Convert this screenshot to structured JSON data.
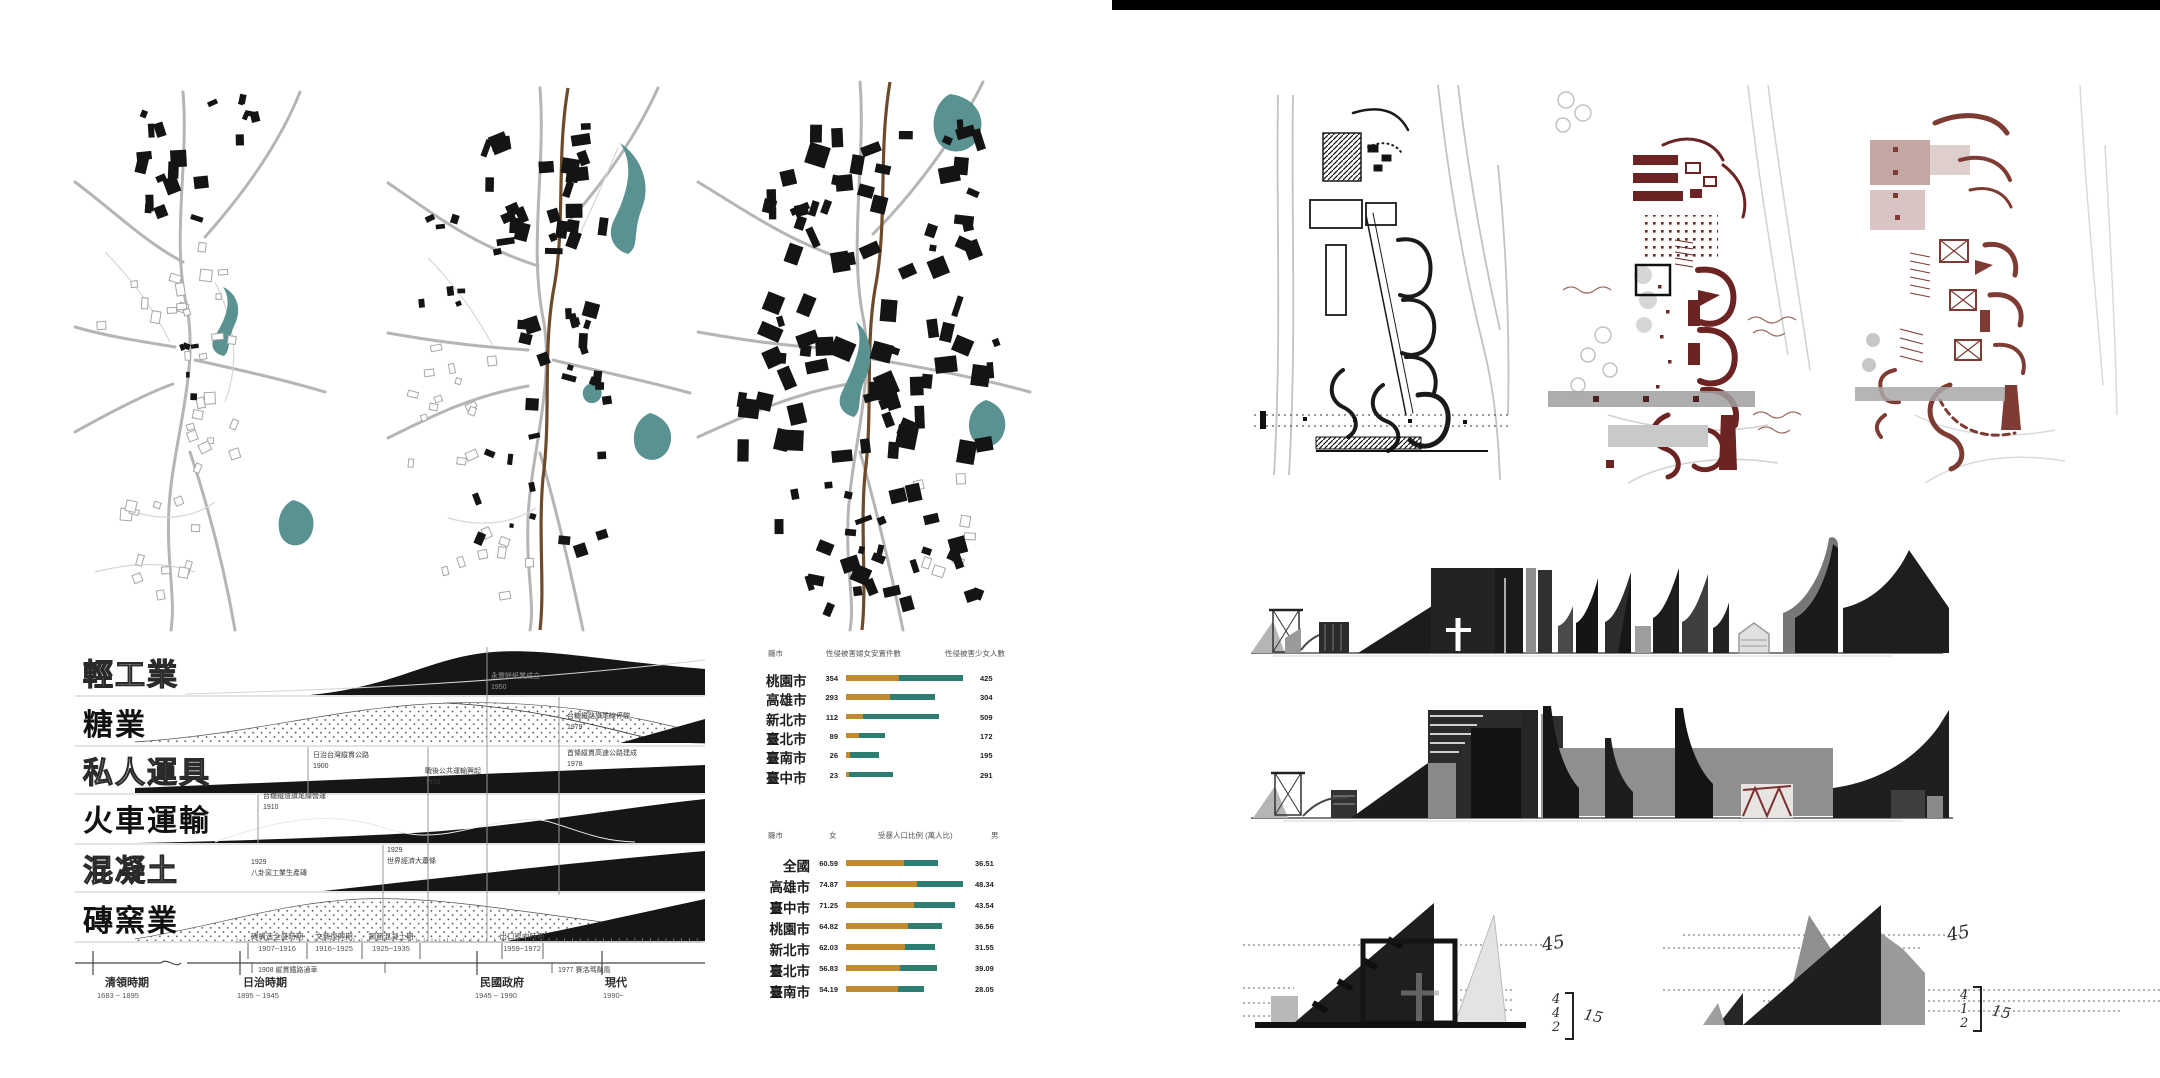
{
  "page": {
    "background": "#ffffff",
    "top_bar_color": "#000000"
  },
  "palette": {
    "ink": "#1a1a1a",
    "water_teal": "#5a9191",
    "road_gray": "#b7b5b3",
    "highway_brown": "#6d4a2a",
    "plan_maroon": "#6b2323",
    "plan_maroon_light": "#7d3b34",
    "bar_gold": "#c28a2e",
    "bar_teal": "#2e7d72"
  },
  "timeline": {
    "rows": [
      {
        "label": "輕工業",
        "style": "outline"
      },
      {
        "label": "糖業",
        "style": "solid"
      },
      {
        "label": "私人運具",
        "style": "outline"
      },
      {
        "label": "火車運輸",
        "style": "solid"
      },
      {
        "label": "混凝土",
        "style": "outline"
      },
      {
        "label": "磚窯業",
        "style": "solid"
      }
    ],
    "annotations": [
      {
        "text": "永豐餘紙業成立",
        "year": "1950"
      },
      {
        "text": "台糖鐵路旗尾線停駛",
        "year": "1979"
      },
      {
        "text": "日治台灣縱貫公路",
        "year": "1900"
      },
      {
        "text": "戰後公共運輸興起",
        "year": "1939"
      },
      {
        "text": "首條縱貫高速公路建成",
        "year": "1978"
      },
      {
        "text": "台糖鐵道旗尾線營運",
        "year": "1910"
      },
      {
        "text": "八卦窯工業生產磚",
        "year": "1929"
      },
      {
        "text": "世界經濟大蕭條",
        "year": "1929"
      }
    ],
    "axis": {
      "periods": [
        {
          "name": "清領時期",
          "range": "1683 ~ 1895"
        },
        {
          "name": "日治時期",
          "range": "1895 ~ 1945"
        },
        {
          "name": "民國政府",
          "range": "1945 ~ 1990"
        },
        {
          "name": "現代",
          "range": "1990~"
        }
      ],
      "sub_periods": [
        {
          "name": "磚構造全盛時期",
          "range": "1907~1916"
        },
        {
          "name": "文藝復興期",
          "range": "1916~1925"
        },
        {
          "name": "鋼筋混凝土期",
          "range": "1925~1935"
        },
        {
          "name": "出口導向時期",
          "range": "1959~1972"
        }
      ],
      "events": [
        {
          "year": "1908",
          "text": "縱貫鐵路通車"
        },
        {
          "year": "1977",
          "text": "賽洛瑪颱風"
        }
      ]
    }
  },
  "chart_data": [
    {
      "type": "bar",
      "orientation": "horizontal",
      "stacked": true,
      "columns": [
        "縣市",
        "性侵被害婦女安置件數",
        "性侵被害少女人數"
      ],
      "categories": [
        "桃園市",
        "高雄市",
        "新北市",
        "臺北市",
        "臺南市",
        "臺中市"
      ],
      "series": [
        {
          "name": "性侵被害婦女安置件數",
          "color": "#c28a2e",
          "values": [
            354,
            293,
            112,
            89,
            26,
            23
          ]
        },
        {
          "name": "性侵被害少女人數",
          "color": "#2e7d72",
          "values": [
            425,
            304,
            509,
            172,
            195,
            291
          ]
        }
      ],
      "legend_position": "none",
      "grid": false
    },
    {
      "type": "bar",
      "orientation": "horizontal",
      "stacked": true,
      "columns": [
        "縣市",
        "女",
        "受暴人口比例 (萬人比)",
        "男"
      ],
      "categories": [
        "全國",
        "高雄市",
        "臺中市",
        "桃園市",
        "新北市",
        "臺北市",
        "臺南市"
      ],
      "series": [
        {
          "name": "女",
          "color": "#c28a2e",
          "values": [
            60.59,
            74.87,
            71.25,
            64.82,
            62.03,
            56.83,
            54.19
          ]
        },
        {
          "name": "男",
          "color": "#2e7d72",
          "values": [
            36.51,
            48.34,
            43.54,
            36.56,
            31.55,
            39.09,
            28.05
          ]
        }
      ],
      "legend_position": "none",
      "grid": false
    }
  ],
  "sketches": {
    "left": {
      "angle_note": "45",
      "dims": [
        "4",
        "4",
        "2"
      ],
      "scale_note": "15"
    },
    "right": {
      "angle_note": "45",
      "dims": [
        "4",
        "1",
        "2"
      ],
      "scale_note": "15"
    }
  }
}
